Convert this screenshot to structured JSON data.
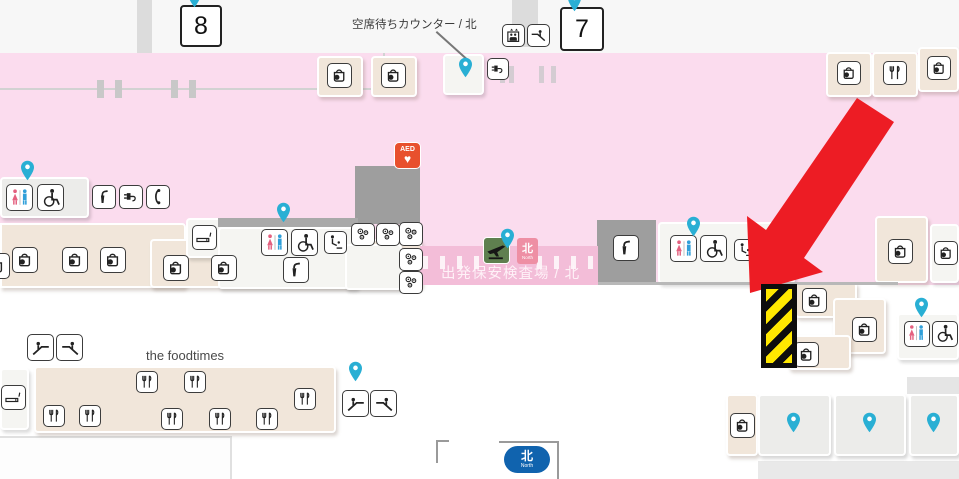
{
  "gates": [
    {
      "number": "8"
    },
    {
      "number": "7"
    }
  ],
  "labels": {
    "standby_counter": "空席待ちカウンター / 北",
    "security": "出発保安検査場 / 北",
    "foodcourt": "the foodtimes",
    "aed": "AED"
  },
  "north_badge": {
    "kanji": "北",
    "en": "North"
  },
  "icons": {
    "aed_heart": "♥",
    "map_pin": "teardrop-marker",
    "shop": "shopping-bag",
    "restaurant": "fork-and-knife",
    "restroom": "male-female-figures",
    "wheelchair": "accessible-wheelchair",
    "escalator_up": "escalator-person-up",
    "escalator_down": "escalator-person-down",
    "elevator": "elevator-cab-arrows",
    "power": "power-plug",
    "phone": "telephone-handset",
    "fountain": "drinking-fountain",
    "smoking": "cigarette",
    "baby_care": "baby-changing",
    "vending": "capsule-machines",
    "departures": "airplane",
    "hazard": "yellow-black-stripes",
    "highlight_arrow": "red-arrow"
  },
  "colors": {
    "pin": "#29afd4",
    "arrow": "#ed1c24",
    "hazard_yellow": "#ffe800",
    "floor_pink": "#fbdcee",
    "security_band_pink": "#f3bdd8",
    "aed_red": "#e8502d",
    "departures_green": "#5f7f4f",
    "north_badge_pink": "#ee8fa4",
    "north_badge_blue": "#1063ae"
  }
}
